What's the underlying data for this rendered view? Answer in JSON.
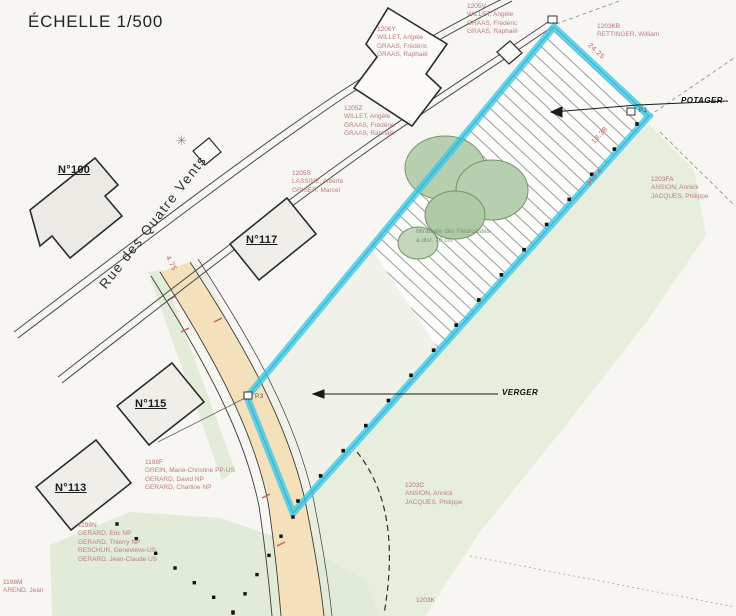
{
  "title": "ÉCHELLE 1/500",
  "street": "Rue des Quatre Vents",
  "zones": {
    "potager": "POTAGER",
    "verger": "VERGER"
  },
  "tree_note": {
    "line1": "Mirabelle des Fleurcastes",
    "line2": "à dist. 70 cm"
  },
  "houses": [
    {
      "label": "N°100",
      "x": 58,
      "y": 164
    },
    {
      "label": "N°117",
      "x": 246,
      "y": 234
    },
    {
      "label": "N°115",
      "x": 135,
      "y": 398
    },
    {
      "label": "N°113",
      "x": 55,
      "y": 482
    }
  ],
  "parcels": [
    {
      "id": "1206Y",
      "owners": [
        "WILLET, Angèle",
        "GRAAS, Frédéric",
        "GRAAS, Raphaël"
      ],
      "x": 377,
      "y": 26
    },
    {
      "id": "1205V",
      "owners": [
        "WILLET, Angèle",
        "GRAAS, Frédéric",
        "GRAAS, Raphaël"
      ],
      "x": 467,
      "y": 3
    },
    {
      "id": "1203KB",
      "owners": [
        "RETTINGER, William"
      ],
      "x": 597,
      "y": 23
    },
    {
      "id": "1205Z",
      "owners": [
        "WILLET, Angèle",
        "GRAAS, Frédéric",
        "GRAAS, Raphaël"
      ],
      "x": 344,
      "y": 105
    },
    {
      "id": "1205S",
      "owners": [
        "LASSINE, Alberte",
        "GRISER, Marcel"
      ],
      "x": 292,
      "y": 170
    },
    {
      "id": "1203FA",
      "owners": [
        "ANSION, Annick",
        "JACQUES, Philippe"
      ],
      "x": 651,
      "y": 176
    },
    {
      "id": "1203C",
      "owners": [
        "ANSION, Annick",
        "JACQUES, Philippe"
      ],
      "x": 405,
      "y": 482
    },
    {
      "id": "1198F",
      "owners": [
        "GREIN, Marie-Christine PP-US",
        "GERARD, David NP",
        "GERARD, Charline NP"
      ],
      "x": 145,
      "y": 459
    },
    {
      "id": "1198N",
      "owners": [
        "GERARD, Eric NP",
        "GERARD, Thierry NP",
        "RESCHUR, Geneviève-US",
        "GERARD, Jean-Claude US"
      ],
      "x": 78,
      "y": 522
    },
    {
      "id": "1198M",
      "owners": [
        "AREND, Jean"
      ],
      "x": 3,
      "y": 579
    },
    {
      "id": "1203K",
      "owners": [],
      "x": 416,
      "y": 597
    }
  ],
  "measurements": [
    {
      "text": "24.25",
      "x": 586,
      "y": 48,
      "rot": 43
    },
    {
      "text": "18.38",
      "x": 590,
      "y": 132,
      "rot": -48
    },
    {
      "text": "352.4",
      "x": 585,
      "y": 174,
      "rot": -48
    },
    {
      "text": "4.75",
      "x": 163,
      "y": 260,
      "rot": 62
    }
  ],
  "markers": [
    {
      "text": "P.1",
      "x": 639,
      "y": 108
    },
    {
      "text": "P.3",
      "x": 255,
      "y": 394
    }
  ],
  "colors": {
    "highlight": "#3cc9e8",
    "parcel_text": "#b87f7f",
    "lane": "#f4e0ba",
    "tree": "#b6cfae"
  }
}
